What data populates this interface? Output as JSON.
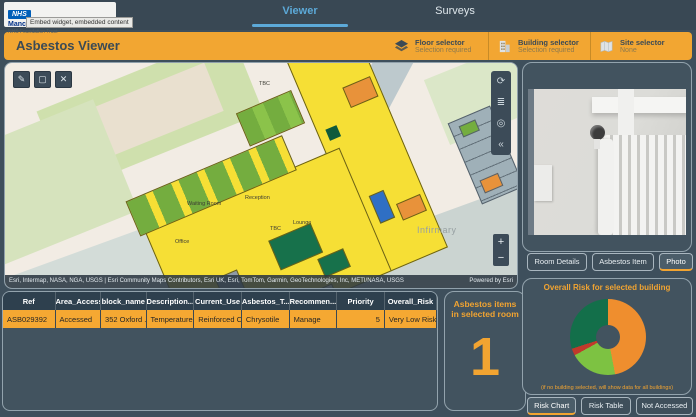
{
  "topbar": {
    "logo": {
      "nhs": "NHS",
      "org": "Manchester University",
      "sub": "NHS Foundation Trust",
      "tooltip": "Embed widget, embedded content"
    },
    "tabs": [
      {
        "label": "Viewer",
        "active": true
      },
      {
        "label": "Surveys",
        "active": false
      }
    ]
  },
  "header": {
    "title": "Asbestos Viewer",
    "selectors": [
      {
        "label": "Floor selector",
        "value": "Selection required",
        "icon": "layers-icon"
      },
      {
        "label": "Building selector",
        "value": "Selection required",
        "icon": "building-icon"
      },
      {
        "label": "Site selector",
        "value": "None",
        "icon": "site-map-icon"
      }
    ]
  },
  "map": {
    "tools": {
      "edit": "✎",
      "select": "▢",
      "close": "✕",
      "refresh": "⟳",
      "legend": "≣",
      "locate": "◎",
      "collapse": "«",
      "zoom_in": "+",
      "zoom_out": "−"
    },
    "labels": {
      "infirmary": "Infirmary",
      "waiting_room": "Waiting Room",
      "reception": "Reception",
      "lounge": "Lounge",
      "tbc": "TBC",
      "office": "Office"
    },
    "attribution": "Esri, Intermap, NASA, NGA, USGS | Esri Community Maps Contributors, Esri UK, Esri, TomTom, Garmin, GeoTechnologies, Inc, METI/NASA, USGS",
    "powered_by": "Powered by Esri"
  },
  "table": {
    "columns": [
      "Ref",
      "Area_Access",
      "block_name",
      "Description...",
      "Current_Use",
      "Asbestos_T...",
      "Recommen...",
      "Priority",
      "Overall_Risk"
    ],
    "rows": [
      [
        "ASB029392",
        "Accessed",
        "352 Oxford ...",
        "Temperature...",
        "Reinforced C...",
        "Chrysotile",
        "Manage",
        "5",
        "Very Low Risk"
      ]
    ]
  },
  "count_panel": {
    "title": "Asbestos items in selected room",
    "value": "1"
  },
  "photo_panel": {
    "buttons": [
      {
        "label": "Room Details",
        "active": false
      },
      {
        "label": "Asbestos Item",
        "active": false
      },
      {
        "label": "Photo",
        "active": true
      }
    ]
  },
  "risk_panel": {
    "title": "Overall Risk for selected building",
    "note": "(if no building selected, will show data for all buildings)",
    "buttons": [
      {
        "label": "Risk Chart",
        "active": true
      },
      {
        "label": "Risk Table",
        "active": false
      },
      {
        "label": "Not Accessed",
        "active": false
      }
    ]
  },
  "chart_data": {
    "type": "pie",
    "donut": true,
    "title": "Overall Risk for selected building",
    "legend_position": "none",
    "segments": [
      {
        "label": "orange-segment",
        "color": "#ef8e2e",
        "pct": 47
      },
      {
        "label": "light-green-segment",
        "color": "#7dc242",
        "pct": 20
      },
      {
        "label": "red-segment",
        "color": "#c0392b",
        "pct": 3
      },
      {
        "label": "dark-green-segment",
        "color": "#136f4a",
        "pct": 30
      }
    ]
  },
  "colors": {
    "accent_orange": "#f2a632",
    "active_tab_blue": "#5ca9d8",
    "panel_bg": "#42535f",
    "page_bg": "#3e4f5c"
  }
}
